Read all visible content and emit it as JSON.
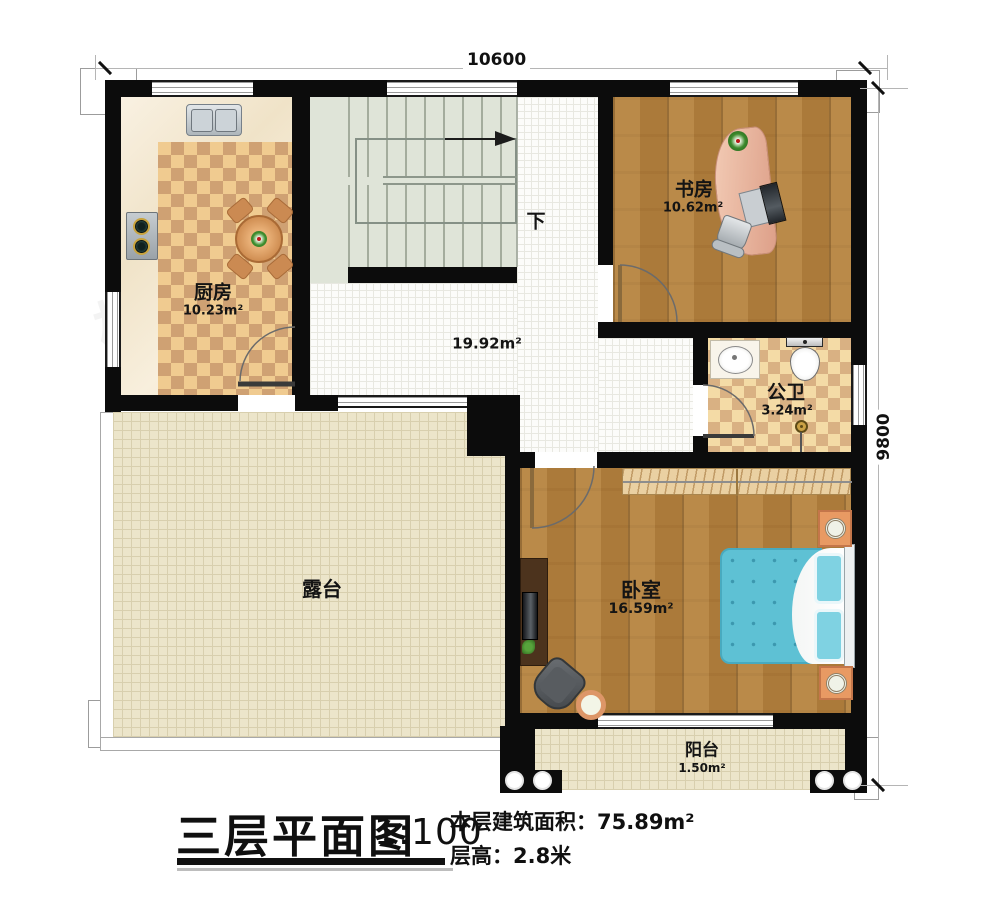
{
  "dimensions": {
    "top": "10600",
    "right": "9800"
  },
  "stairs": {
    "down_label": "下"
  },
  "rooms": {
    "kitchen": {
      "name": "厨房",
      "area": "10.23m²"
    },
    "study": {
      "name": "书房",
      "area": "10.62m²"
    },
    "bathroom": {
      "name": "公卫",
      "area": "3.24m²"
    },
    "bedroom": {
      "name": "卧室",
      "area": "16.59m²"
    },
    "hall": {
      "area": "19.92m²"
    },
    "terrace": {
      "name": "露台"
    },
    "balcony": {
      "name": "阳台",
      "area": "1.50m²"
    }
  },
  "title_block": {
    "title": "三层平面图",
    "scale": "1:100",
    "floor_area_label": "本层建筑面积：",
    "floor_area_value": "75.89m²",
    "floor_height_label": "层高：",
    "floor_height_value": "2.8米"
  },
  "watermark": {
    "brand": "柏竣建筑"
  },
  "colors": {
    "wall": "#0c0c0c",
    "wood_floor": "#b2803e",
    "kitchen_checker_light": "#f0cb90",
    "kitchen_checker_dark": "#cfa173",
    "bath_checker_light": "#f4dba6",
    "bath_checker_dark": "#d9b183",
    "hall_tile": "#fcfcfa",
    "terrace_tile": "#ece5ca",
    "stair_fill": "#dfe4d8",
    "bed_blue": "#5ec1d4",
    "desk_pink": "#eec0ac",
    "nightstand_orange": "#e89a63"
  }
}
